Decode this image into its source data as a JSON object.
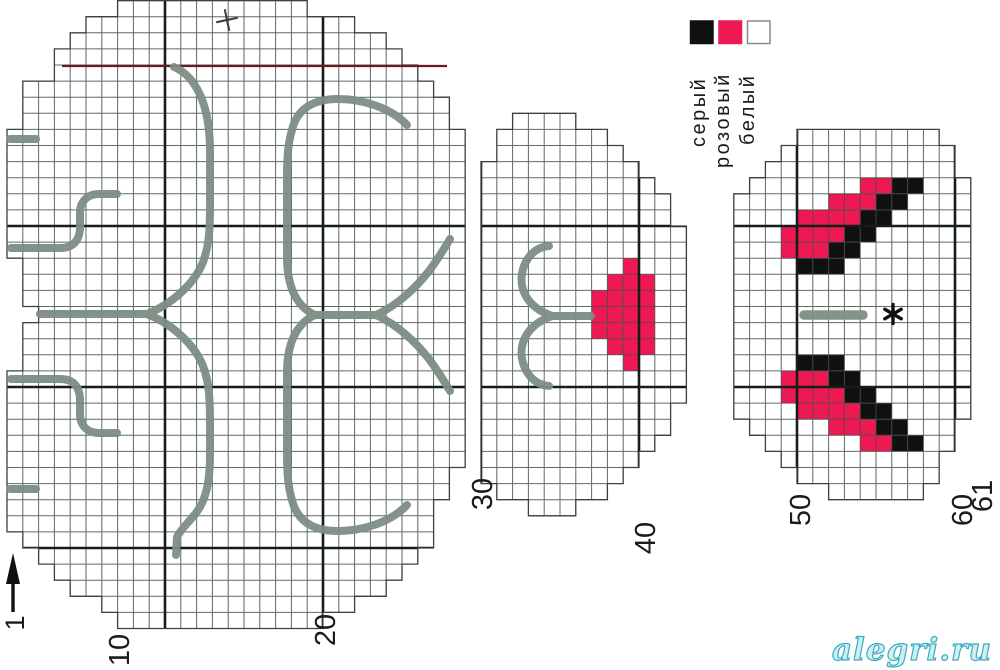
{
  "watermark": "alegri.ru",
  "legend": {
    "swatch_size": 22.5,
    "swatch_y": 21,
    "items": [
      {
        "name": "gray",
        "x": 690.5,
        "color": "#101010",
        "border": "#101010",
        "label": "серый",
        "label_x": 705,
        "label_y": 147
      },
      {
        "name": "pink",
        "x": 719.0,
        "color": "#ee1853",
        "border": "#ee1853",
        "label": "розовый",
        "label_x": 729,
        "label_y": 168
      },
      {
        "name": "white",
        "x": 747.5,
        "color": "#ffffff",
        "border": "#8a8a8a",
        "label": "белый",
        "label_x": 754,
        "label_y": 145
      }
    ]
  },
  "axis": {
    "column_labels": [
      {
        "text": "10",
        "x": 120,
        "y": 650
      },
      {
        "text": "20",
        "x": 326,
        "y": 630
      },
      {
        "text": "30",
        "x": 483,
        "y": 494
      },
      {
        "text": "40",
        "x": 646,
        "y": 538
      },
      {
        "text": "50",
        "x": 801,
        "y": 510
      },
      {
        "text": "60",
        "x": 963,
        "y": 510
      },
      {
        "text": "61",
        "x": 983,
        "y": 496
      }
    ],
    "row_arrow": {
      "label": "1",
      "label_x": 15,
      "label_y": 623,
      "shaft": [
        13,
        612,
        13,
        580
      ],
      "head": [
        [
          6,
          584
        ],
        [
          13,
          553
        ],
        [
          20,
          584
        ]
      ]
    }
  },
  "grid": {
    "x0": 7,
    "y0": 65,
    "cell_w": 15.8,
    "cell_h": 16.1,
    "cols": 62,
    "row_min": -4,
    "row_max": 35
  },
  "colors": {
    "paper": "#ffffff",
    "grid_minor": "#44504a",
    "grid_major": "#151d19",
    "outline": "#39433d",
    "red_guide": "#6d1824",
    "stitch_gray": "#7d8e84",
    "pink": "#ee1853",
    "black": "#101010",
    "text": "#1b1b1b"
  },
  "pieces": [
    {
      "name": "body",
      "bold_cols": [
        10,
        20
      ],
      "bold_rows": [
        10,
        20,
        30
      ],
      "outline": [
        [
          117.6,
          0.6
        ],
        [
          307.2,
          0.6
        ],
        [
          307.2,
          16.7
        ],
        [
          354.6,
          16.7
        ],
        [
          354.6,
          32.8
        ],
        [
          386.2,
          32.8
        ],
        [
          386.2,
          48.9
        ],
        [
          402,
          48.9
        ],
        [
          402,
          65
        ],
        [
          417.8,
          65
        ],
        [
          417.8,
          81.1
        ],
        [
          433.6,
          81.1
        ],
        [
          433.6,
          97.2
        ],
        [
          449.4,
          97.2
        ],
        [
          449.4,
          129.4
        ],
        [
          465.2,
          129.4
        ],
        [
          465.2,
          467.5
        ],
        [
          449.4,
          467.5
        ],
        [
          449.4,
          499.7
        ],
        [
          433.6,
          499.7
        ],
        [
          433.6,
          548
        ],
        [
          417.8,
          548
        ],
        [
          417.8,
          564.1
        ],
        [
          402,
          564.1
        ],
        [
          402,
          580.2
        ],
        [
          386.2,
          580.2
        ],
        [
          386.2,
          596.3
        ],
        [
          354.6,
          596.3
        ],
        [
          354.6,
          612.4
        ],
        [
          322.9,
          612.4
        ],
        [
          322.9,
          628.5
        ],
        [
          117.6,
          628.5
        ],
        [
          117.6,
          612.4
        ],
        [
          101.8,
          612.4
        ],
        [
          101.8,
          596.3
        ],
        [
          70.2,
          596.3
        ],
        [
          70.2,
          580.2
        ],
        [
          54.4,
          580.2
        ],
        [
          54.4,
          564.1
        ],
        [
          38.6,
          564.1
        ],
        [
          38.6,
          548
        ],
        [
          22.8,
          548
        ],
        [
          22.8,
          531.9
        ],
        [
          7,
          531.9
        ],
        [
          7,
          370.9
        ],
        [
          22.8,
          370.9
        ],
        [
          22.8,
          322.6
        ],
        [
          38.6,
          322.6
        ],
        [
          38.6,
          306.5
        ],
        [
          22.8,
          306.5
        ],
        [
          22.8,
          258.2
        ],
        [
          7,
          258.2
        ],
        [
          7,
          129.4
        ],
        [
          22.8,
          129.4
        ],
        [
          22.8,
          81.1
        ],
        [
          54.4,
          81.1
        ],
        [
          54.4,
          48.9
        ],
        [
          70.2,
          48.9
        ],
        [
          70.2,
          32.8
        ],
        [
          86,
          32.8
        ],
        [
          86,
          16.7
        ],
        [
          117.6,
          16.7
        ]
      ]
    },
    {
      "name": "head",
      "bold_cols": [
        30,
        40
      ],
      "bold_rows": [
        10,
        20
      ],
      "outline": [
        [
          528.4,
          113.3
        ],
        [
          575.8,
          113.3
        ],
        [
          575.8,
          129.4
        ],
        [
          607.4,
          129.4
        ],
        [
          607.4,
          145.5
        ],
        [
          623.2,
          145.5
        ],
        [
          623.2,
          161.6
        ],
        [
          639,
          161.6
        ],
        [
          639,
          177.7
        ],
        [
          654.8,
          177.7
        ],
        [
          654.8,
          193.8
        ],
        [
          670.6,
          193.8
        ],
        [
          670.6,
          226
        ],
        [
          686.4,
          226
        ],
        [
          686.4,
          403.1
        ],
        [
          670.6,
          403.1
        ],
        [
          670.6,
          435.3
        ],
        [
          654.8,
          435.3
        ],
        [
          654.8,
          451.4
        ],
        [
          639,
          451.4
        ],
        [
          639,
          467.5
        ],
        [
          623.2,
          467.5
        ],
        [
          623.2,
          483.6
        ],
        [
          607.4,
          483.6
        ],
        [
          607.4,
          499.7
        ],
        [
          575.8,
          499.7
        ],
        [
          575.8,
          515.8
        ],
        [
          528.4,
          515.8
        ],
        [
          528.4,
          499.7
        ],
        [
          496.8,
          499.7
        ],
        [
          496.8,
          483.6
        ],
        [
          481,
          483.6
        ],
        [
          481,
          161.6
        ],
        [
          496.8,
          161.6
        ],
        [
          496.8,
          129.4
        ],
        [
          512.6,
          129.4
        ],
        [
          512.6,
          113.3
        ]
      ]
    },
    {
      "name": "ears",
      "bold_cols": [
        50,
        60
      ],
      "bold_rows": [
        10,
        20
      ],
      "outline": [
        [
          812.8,
          129.4
        ],
        [
          939.2,
          129.4
        ],
        [
          939.2,
          145.5
        ],
        [
          955,
          145.5
        ],
        [
          955,
          177.7
        ],
        [
          970.8,
          177.7
        ],
        [
          970.8,
          419.2
        ],
        [
          955,
          419.2
        ],
        [
          955,
          451.4
        ],
        [
          939.2,
          451.4
        ],
        [
          939.2,
          483.6
        ],
        [
          923.4,
          483.6
        ],
        [
          923.4,
          499.7
        ],
        [
          828.6,
          499.7
        ],
        [
          828.6,
          483.6
        ],
        [
          797,
          483.6
        ],
        [
          797,
          467.5
        ],
        [
          781.2,
          467.5
        ],
        [
          781.2,
          451.4
        ],
        [
          765.4,
          451.4
        ],
        [
          765.4,
          435.3
        ],
        [
          749.6,
          435.3
        ],
        [
          749.6,
          419.2
        ],
        [
          733.8,
          419.2
        ],
        [
          733.8,
          193.8
        ],
        [
          749.6,
          193.8
        ],
        [
          749.6,
          177.7
        ],
        [
          765.4,
          177.7
        ],
        [
          765.4,
          161.6
        ],
        [
          781.2,
          161.6
        ],
        [
          781.2,
          145.5
        ],
        [
          797,
          145.5
        ],
        [
          797,
          129.4
        ]
      ]
    }
  ],
  "cells": {
    "pink": [
      [
        40,
        13
      ],
      [
        39,
        14
      ],
      [
        40,
        14
      ],
      [
        41,
        14
      ],
      [
        38,
        15
      ],
      [
        39,
        15
      ],
      [
        40,
        15
      ],
      [
        41,
        15
      ],
      [
        38,
        16
      ],
      [
        39,
        16
      ],
      [
        40,
        16
      ],
      [
        41,
        16
      ],
      [
        38,
        17
      ],
      [
        39,
        17
      ],
      [
        40,
        17
      ],
      [
        41,
        17
      ],
      [
        39,
        18
      ],
      [
        40,
        18
      ],
      [
        41,
        18
      ],
      [
        40,
        19
      ],
      [
        55,
        8
      ],
      [
        56,
        8
      ],
      [
        53,
        9
      ],
      [
        54,
        9
      ],
      [
        55,
        9
      ],
      [
        51,
        10
      ],
      [
        52,
        10
      ],
      [
        53,
        10
      ],
      [
        54,
        10
      ],
      [
        50,
        11
      ],
      [
        51,
        11
      ],
      [
        52,
        11
      ],
      [
        53,
        11
      ],
      [
        50,
        12
      ],
      [
        51,
        12
      ],
      [
        52,
        12
      ],
      [
        50,
        20
      ],
      [
        51,
        20
      ],
      [
        52,
        20
      ],
      [
        50,
        21
      ],
      [
        51,
        21
      ],
      [
        52,
        21
      ],
      [
        53,
        21
      ],
      [
        51,
        22
      ],
      [
        52,
        22
      ],
      [
        53,
        22
      ],
      [
        54,
        22
      ],
      [
        53,
        23
      ],
      [
        54,
        23
      ],
      [
        55,
        23
      ],
      [
        55,
        24
      ],
      [
        56,
        24
      ]
    ],
    "black": [
      [
        57,
        8
      ],
      [
        58,
        8
      ],
      [
        56,
        9
      ],
      [
        57,
        9
      ],
      [
        55,
        10
      ],
      [
        56,
        10
      ],
      [
        54,
        11
      ],
      [
        55,
        11
      ],
      [
        53,
        12
      ],
      [
        54,
        12
      ],
      [
        51,
        13
      ],
      [
        52,
        13
      ],
      [
        53,
        13
      ],
      [
        51,
        19
      ],
      [
        52,
        19
      ],
      [
        53,
        19
      ],
      [
        53,
        20
      ],
      [
        54,
        20
      ],
      [
        54,
        21
      ],
      [
        55,
        21
      ],
      [
        55,
        22
      ],
      [
        56,
        22
      ],
      [
        56,
        23
      ],
      [
        57,
        23
      ],
      [
        57,
        24
      ],
      [
        58,
        24
      ]
    ]
  },
  "red_guide": {
    "x1": 62,
    "y1": 66,
    "x2": 447,
    "y2": 66,
    "width": 2.2
  },
  "backstitch": {
    "width": 8,
    "paths": [
      {
        "d": "M 10 139 L 36 139"
      },
      {
        "d": "M 11 248 L 60 248 C 73 248 79 241 80 229 L 80 213 C 80 202 87 194 99 194 L 117 194"
      },
      {
        "d": "M 40 314 L 147 314"
      },
      {
        "d": "M 147 314 C 170 305 194 285 203 262 C 209 246 210 231 210 204 L 210 152 C 210 124 205 100 194 84 C 188 75 181 70 174 67"
      },
      {
        "d": "M 147 314 C 170 323 194 343 203 366 C 209 382 210 397 210 424 L 210 454 C 210 482 206 500 196 513 C 189 522 181 529 177 537 L 176 555"
      },
      {
        "d": "M 11 379 L 60 379 C 73 379 79 386 80 398 L 80 414 C 80 425 87 433 99 433 L 117 433"
      },
      {
        "d": "M 10 489 L 36 489"
      },
      {
        "d": "M 407 125 C 391 108 363 99 338 99 C 313 99 297 109 292 130 C 288 143 287 158 287 178 L 287 257 C 287 284 295 306 315 315"
      },
      {
        "d": "M 315 315 L 376 315"
      },
      {
        "d": "M 376 315 C 396 306 415 289 429 271 C 438 259 444 249 450 239"
      },
      {
        "d": "M 376 315 C 396 324 415 341 429 359 C 438 371 444 381 450 391"
      },
      {
        "d": "M 315 315 C 295 324 287 346 287 373 L 287 452 C 287 472 288 487 292 500 C 297 521 313 531 338 531 C 363 531 391 522 407 505"
      },
      {
        "d": "M 549 246 C 536 247 527 256 523 269 C 519 282 523 296 533 305 C 538 310 544 313 552 316"
      },
      {
        "d": "M 552 316 L 591 316"
      },
      {
        "d": "M 552 316 C 544 319 538 322 533 327 C 523 336 519 350 523 363 C 527 376 536 385 549 386"
      },
      {
        "d": "M 804 315 L 863 315",
        "w": 9.5
      }
    ]
  },
  "marks": {
    "plus": {
      "x": 227,
      "y": 20,
      "arm": 11,
      "rotate": -12
    },
    "star": {
      "x": 893,
      "y": 314,
      "r": 9.5
    }
  }
}
